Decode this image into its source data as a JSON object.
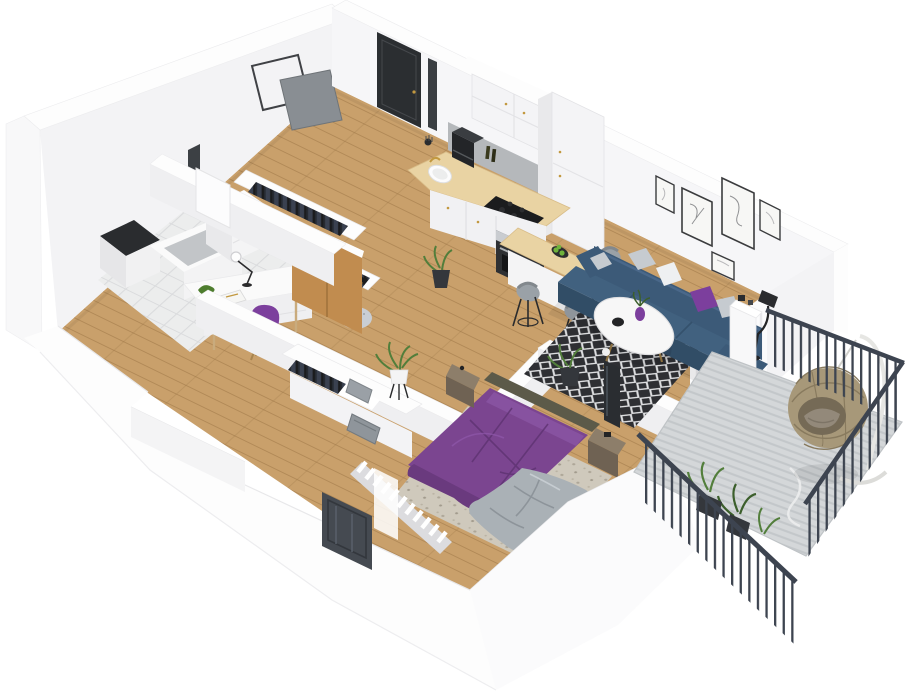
{
  "scene": {
    "kind": "3d-isometric-apartment-floor-plan-render",
    "canvas_width": 916,
    "canvas_height": 700,
    "background": "#ffffff"
  },
  "palette": {
    "wallWhite": "#fdfdfd",
    "wallFace": "#f3f3f5",
    "wallShade": "#efeff1",
    "wallDark": "#e6e6e9",
    "wood": "#c9a06b",
    "tile": "#eceded",
    "counter": "#e9d3a3",
    "cabinet": "#f4f4f6",
    "backsplash": "#b5b8bb",
    "applianceDark": "#1b1c1e",
    "steel": "#c9ccd0",
    "sofa": "#3c5a78",
    "sofaSeat": "#41617f",
    "sofaDark": "#314d66",
    "pillowWhite": "#eef0f2",
    "pillowGray": "#c6cbd0",
    "accentPurple": "#7c3f9d",
    "bedPurple": "#7b4590",
    "bedPurpleDark": "#5e3270",
    "blanket": "#aab1b6",
    "rugDark": "#2e2f33",
    "rugDiamond": "#dfe0e2",
    "bedroomRug": "#cfc9bc",
    "oak": "#c18c4f",
    "oakDark": "#9c6f3a",
    "rail": "#3d4450",
    "concrete": "#d4d7d9",
    "concreteLine": "#c3c7ca",
    "rattan": "#a79879",
    "rattanDark": "#887a5e",
    "cushion": "#93897a",
    "plantGreen": "#527e3b",
    "plantDark": "#3c5f2c",
    "potDark": "#34373c",
    "paper": "#f7f7f5",
    "frameDark": "#3b3c3e",
    "chairGray": "#9aa1a7",
    "legDark": "#2a2b2d",
    "gold": "#c2983f",
    "doorDark": "#2b2e31",
    "glassDark": "#454a51",
    "basketGray": "#9aa0a6",
    "nightstand": "#8d7e6a",
    "nightstandDark": "#6f6253",
    "headboard": "#5c5a49",
    "apple": "#6fb33c"
  },
  "rooms": [
    {
      "id": "bathroom",
      "contents": [
        "washing-machine",
        "shower-tray",
        "sink-vanity",
        "wall-mirror"
      ]
    },
    {
      "id": "hallway",
      "contents": [
        "entrance-door",
        "open-wardrobe-rack",
        "open-wardrobe-rack",
        "oak-wardrobe",
        "floor-plant"
      ]
    },
    {
      "id": "office",
      "contents": [
        "desk",
        "desk-lamp",
        "toy-dinosaur",
        "book",
        "purple-tulip-chair",
        "gray-pouf",
        "purple-pouf",
        "overlapping-squares-art"
      ]
    },
    {
      "id": "kitchen",
      "contents": [
        "upper-cabinets",
        "tall-cabinet",
        "backsplash",
        "countertop",
        "sink",
        "gold-faucet",
        "coffee-machine",
        "cooktop",
        "oven",
        "oil-bottles",
        "bar-counter",
        "bar-stool",
        "bar-stool",
        "bar-stool",
        "apple-plate"
      ]
    },
    {
      "id": "living-room",
      "contents": [
        "gallery-wall-frames",
        "blue-sofa",
        "throw-pillows",
        "diamond-rug",
        "round-coffee-table",
        "purple-vase",
        "floor-lamp",
        "floor-plant",
        "sideboard",
        "balcony-curtain-door"
      ]
    },
    {
      "id": "bedroom",
      "contents": [
        "purple-double-bed",
        "gray-throw-blanket",
        "nightstand",
        "nightstand",
        "open-closet-with-baskets",
        "leaning-mirror",
        "radiator",
        "glass-door",
        "floor-plant",
        "mottled-rug"
      ]
    },
    {
      "id": "balcony",
      "contents": [
        "hanging-egg-chair",
        "metal-railing",
        "potted-plants",
        "concrete-decking"
      ]
    }
  ]
}
